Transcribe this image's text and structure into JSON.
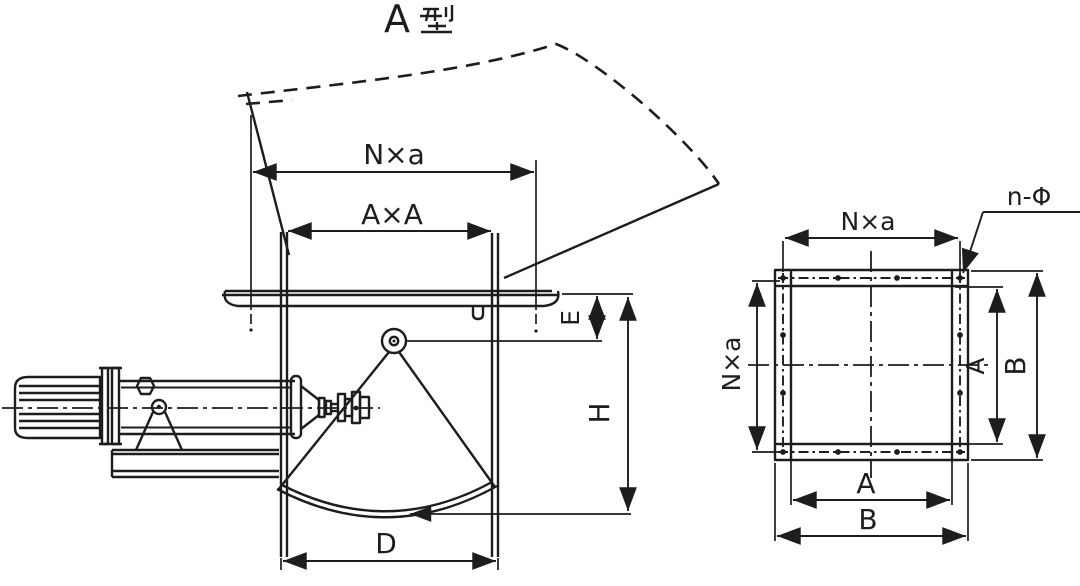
{
  "title": {
    "text": "A型",
    "latin_part": "A"
  },
  "colors": {
    "ink": "#1d1d1d",
    "paper": "#ffffff"
  },
  "left_view": {
    "description": "side elevation of type-A sector discharge gate with electric actuator",
    "dim_top_width": "N×a",
    "dim_inlet": "A×A",
    "dim_pivot_offset": "E",
    "dim_height": "H",
    "dim_flap_width": "D"
  },
  "right_view": {
    "description": "plan of square inlet flange with bolt holes",
    "dim_bolt_span_top": "N×a",
    "dim_bolt_span_side": "N×a",
    "bolt_hole_callout": "n-Φ",
    "dim_inner_vertical": "A",
    "dim_outer_vertical": "B",
    "dim_inner_horizontal": "A",
    "dim_outer_horizontal": "B"
  }
}
